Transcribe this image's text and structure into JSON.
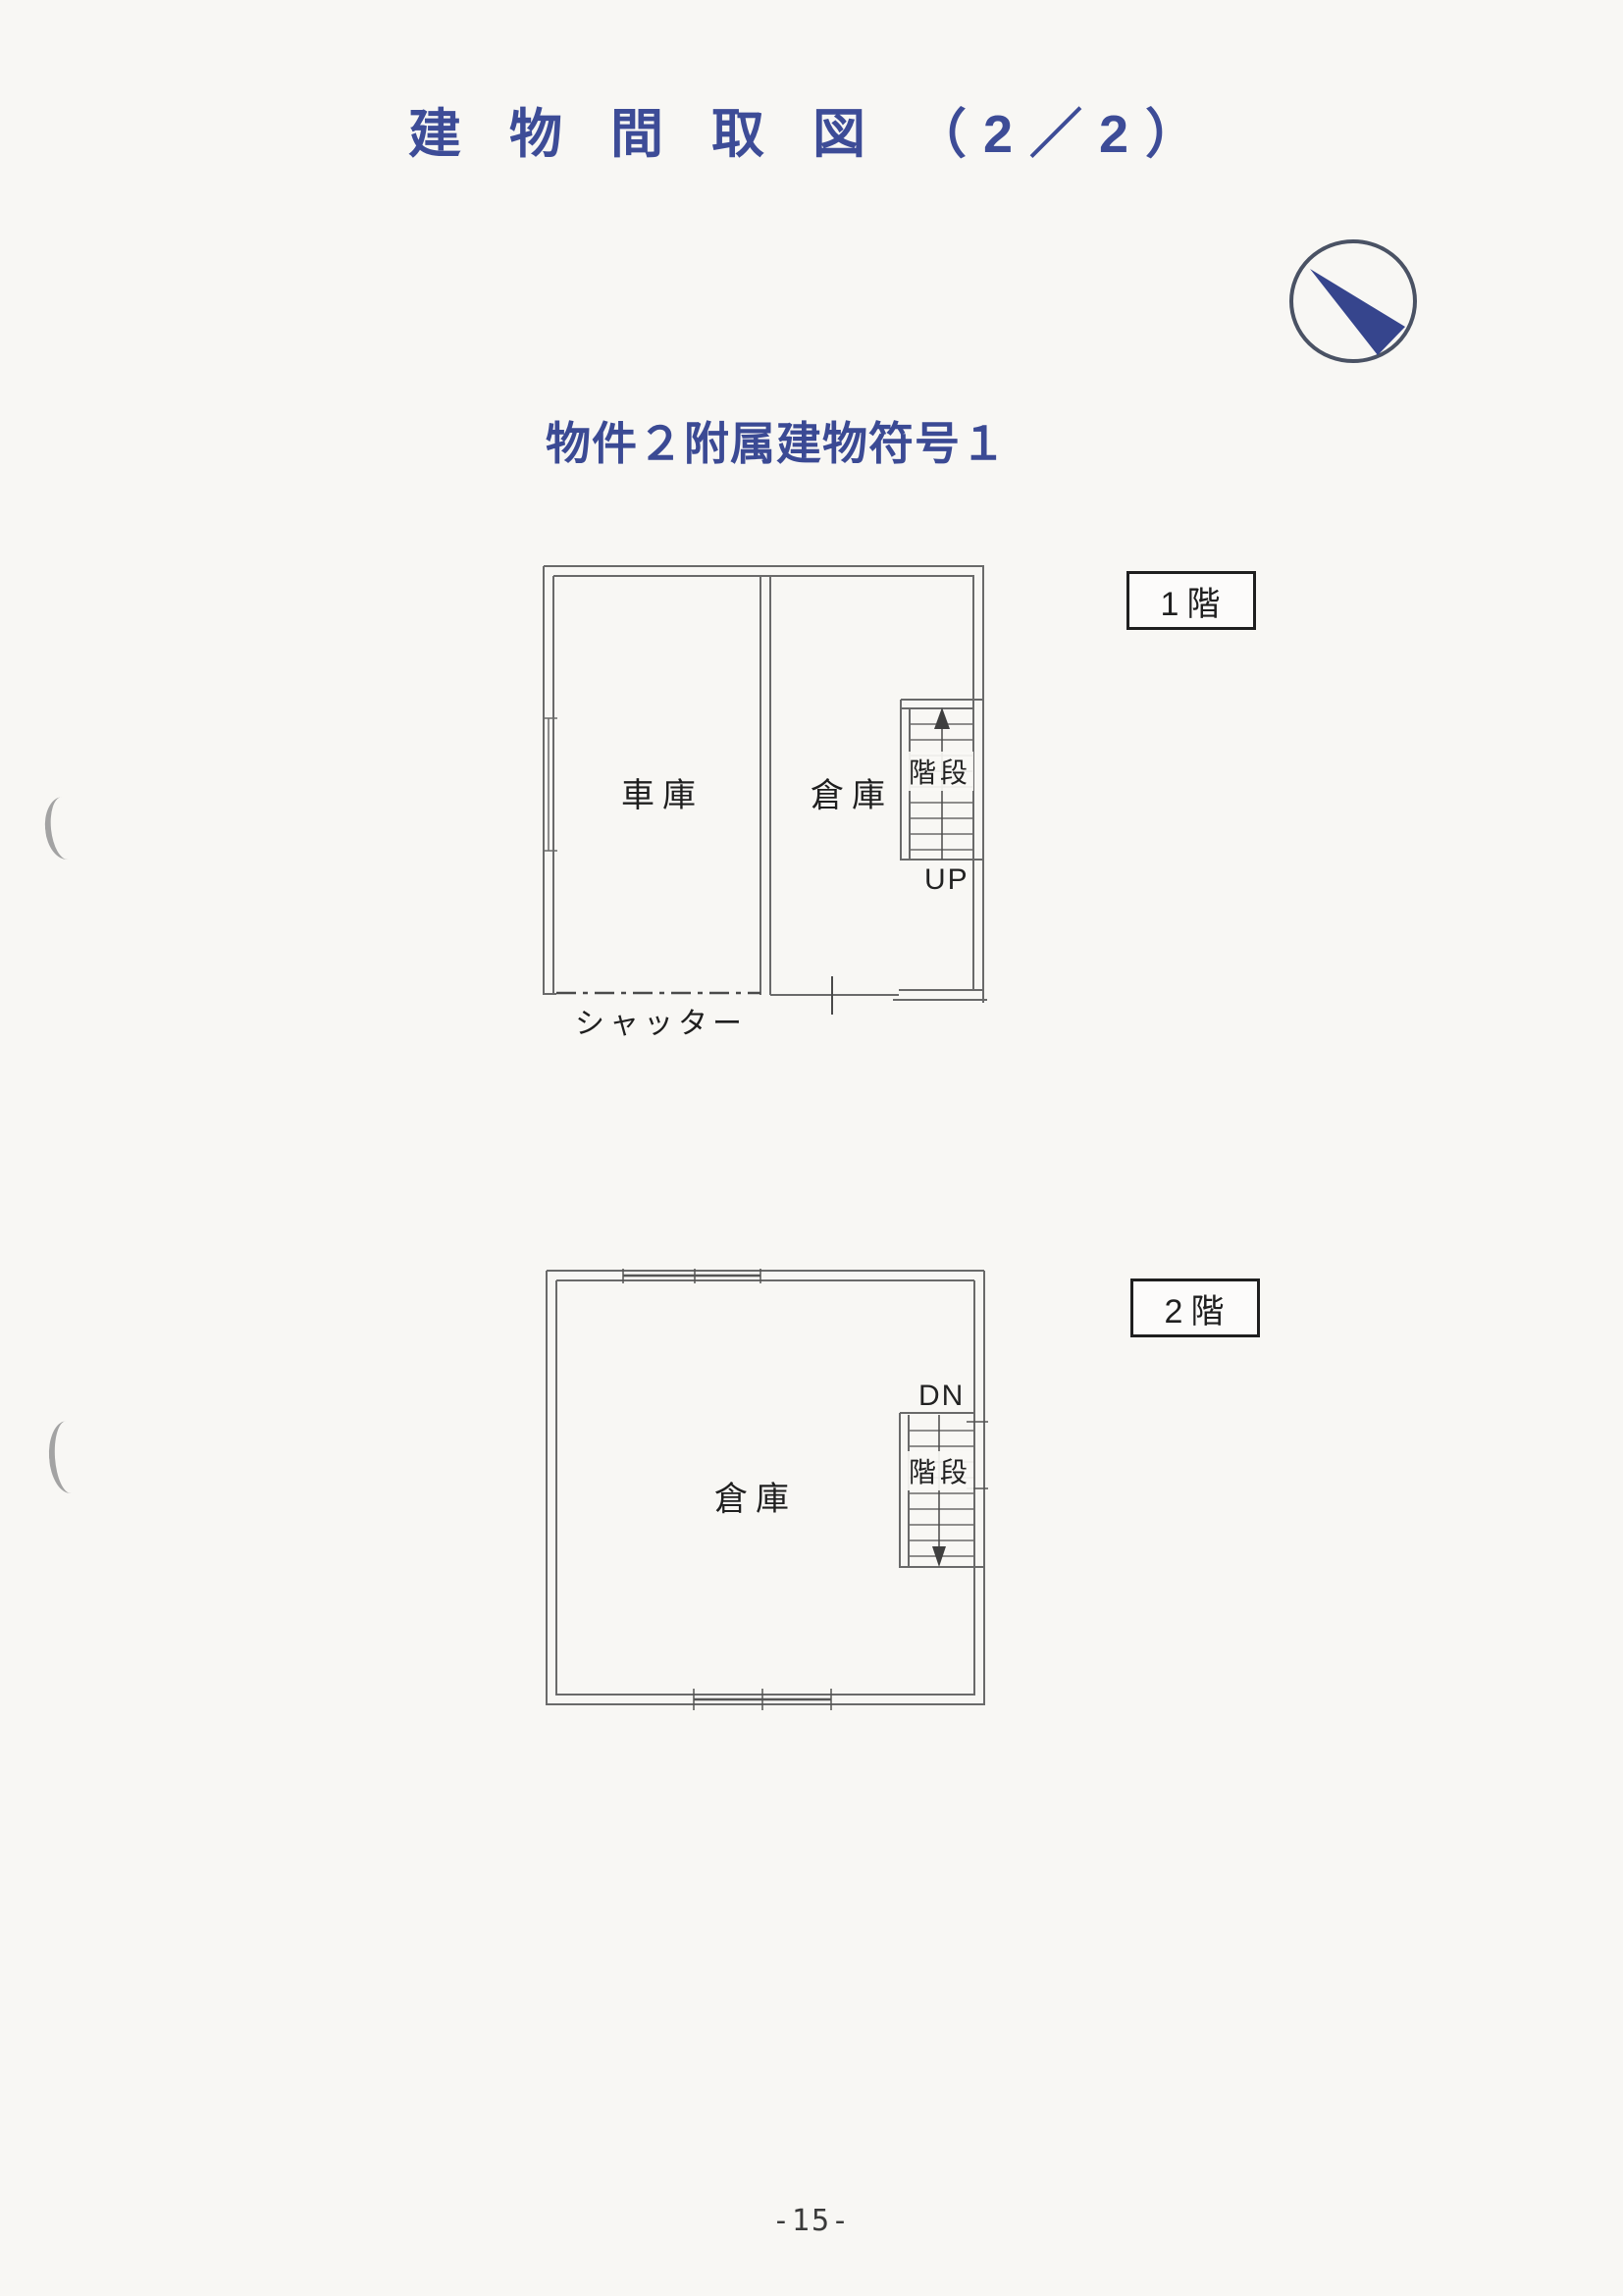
{
  "document": {
    "title": "建 物 間 取 図 （2／2）",
    "subtitle": "物件２附属建物符号１",
    "page_number": "-15-"
  },
  "compass": {
    "icon": "north-arrow-icon",
    "needle_color": "#36458d",
    "ring_color": "#4a5264"
  },
  "floor1": {
    "floor_badge": "1階",
    "garage_label": "車庫",
    "warehouse_label": "倉庫",
    "stairs_label": "階段",
    "stairs_direction": "UP",
    "shutter_label": "シャッター"
  },
  "floor2": {
    "floor_badge": "2階",
    "warehouse_label": "倉庫",
    "stairs_label": "階段",
    "stairs_direction": "DN"
  },
  "colors": {
    "heading_blue": "#3d4c97",
    "wall_line": "#6a6a6a",
    "label_text": "#1f1f1f",
    "paper": "#f8f7f4"
  }
}
